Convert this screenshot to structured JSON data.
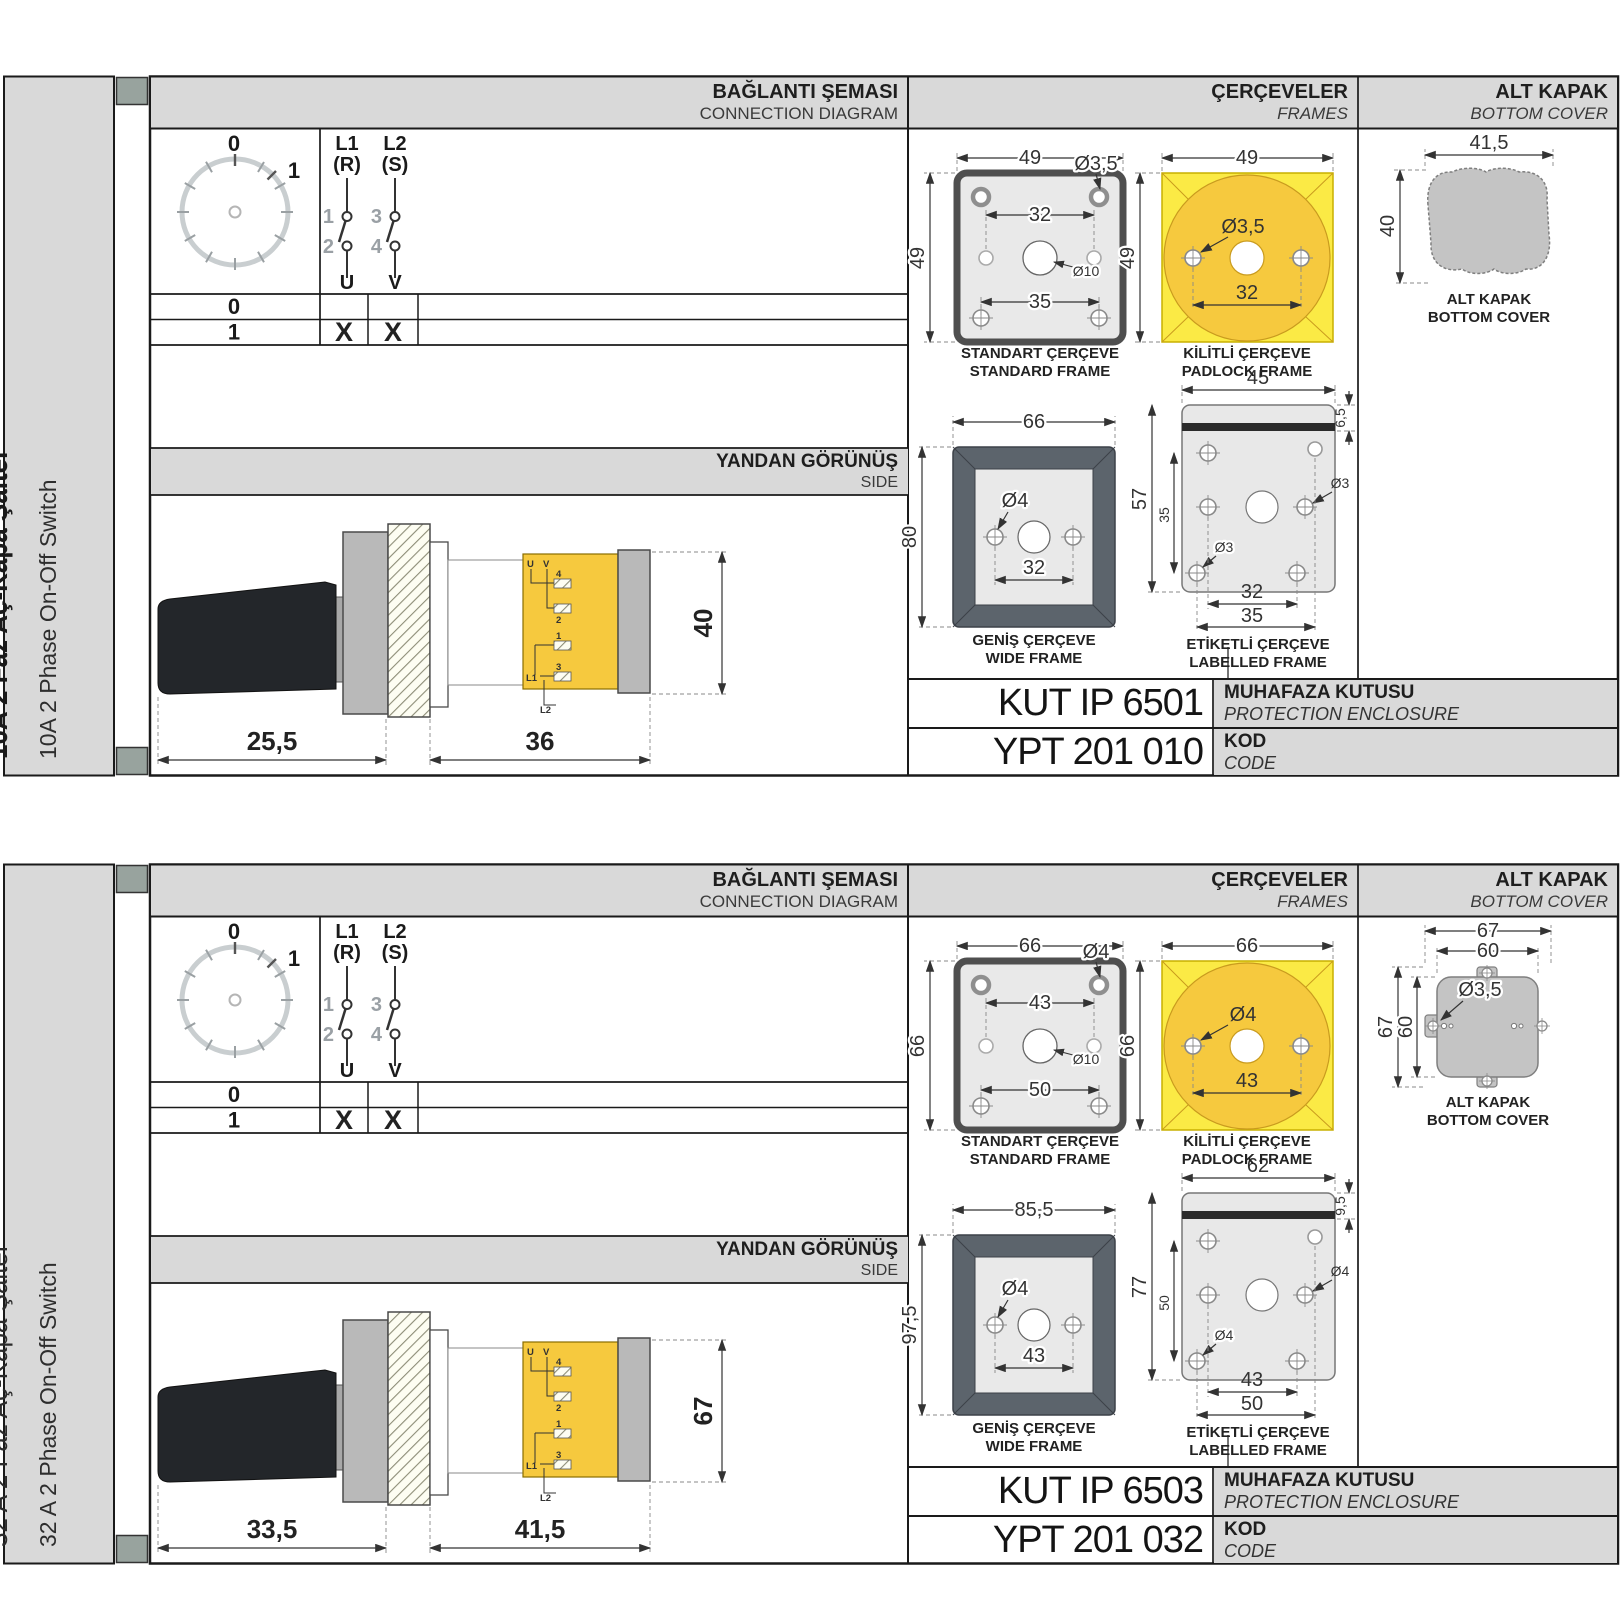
{
  "headers": {
    "connection_tr": "BAĞLANTI ŞEMASI",
    "connection_en": "CONNECTION DIAGRAM",
    "frames_tr": "ÇERÇEVELER",
    "frames_en": "FRAMES",
    "cover_tr": "ALT KAPAK",
    "cover_en": "BOTTOM COVER",
    "side_tr": "YANDAN GÖRÜNÜŞ",
    "side_en": "SIDE",
    "enclosure_tr": "MUHAFAZA KUTUSU",
    "enclosure_en": "PROTECTION ENCLOSURE",
    "code_tr": "KOD",
    "code_en": "CODE"
  },
  "frame_labels": {
    "standard_tr": "STANDART ÇERÇEVE",
    "standard_en": "STANDARD FRAME",
    "padlock_tr": "KİLİTLİ ÇERÇEVE",
    "padlock_en": "PADLOCK FRAME",
    "wide_tr": "GENİŞ ÇERÇEVE",
    "wide_en": "WIDE FRAME",
    "labelled_tr": "ETİKETLİ ÇERÇEVE",
    "labelled_en": "LABELLED FRAME",
    "cover_tr": "ALT KAPAK",
    "cover_en": "BOTTOM COVER"
  },
  "diagram": {
    "positions": [
      "0",
      "1"
    ],
    "col1": {
      "line": "L1",
      "phase": "(R)",
      "t_top": "1",
      "t_bot": "2",
      "out": "U"
    },
    "col2": {
      "line": "L2",
      "phase": "(S)",
      "t_top": "3",
      "t_bot": "4",
      "out": "V"
    },
    "rows": [
      {
        "label": "0",
        "c1": "",
        "c2": ""
      },
      {
        "label": "1",
        "c1": "X",
        "c2": "X"
      }
    ]
  },
  "side_terminals": {
    "u": "U",
    "v": "V",
    "n4": "4",
    "n2": "2",
    "n1": "1",
    "n3": "3",
    "l1": "L1",
    "l2": "L2"
  },
  "colors": {
    "panel_gray": "#d9d9d9",
    "tab_square": "#98a39e",
    "yellow_square": "#fbea45",
    "yellow_circle": "#f6c93e",
    "frame_dark": "#5c646c",
    "cover_gray": "#c4c4c4"
  },
  "sections": [
    {
      "title_tr": "10A 2 Faz Aç-Kapa Şalter",
      "title_en": "10A 2 Phase On-Off Switch",
      "side": {
        "d1": "25,5",
        "d2": "36",
        "h": "40"
      },
      "standard": {
        "w": "49",
        "h": "49",
        "hole": "Ø3,5",
        "inner": "32",
        "center": "Ø10",
        "bottom": "35"
      },
      "padlock": {
        "w": "49",
        "h": "49",
        "hole": "Ø3,5",
        "inner": "32"
      },
      "wide": {
        "w": "66",
        "h": "80",
        "hole": "Ø4",
        "inner": "32"
      },
      "labelled": {
        "w": "45",
        "top": "6,5",
        "h": "57",
        "h2": "35",
        "hole1": "Ø3",
        "hole2": "Ø3",
        "b1": "32",
        "b2": "35"
      },
      "cover": {
        "w": "41,5",
        "h": "40"
      },
      "enclosure_code": "KUT IP 6501",
      "code": "YPT 201 010"
    },
    {
      "title_tr": "32 A 2 Faz Aç-Kapa Şalter",
      "title_en": "32 A 2 Phase On-Off Switch",
      "side": {
        "d1": "33,5",
        "d2": "41,5",
        "h": "67"
      },
      "standard": {
        "w": "66",
        "h": "66",
        "hole": "Ø4",
        "inner": "43",
        "center": "Ø10",
        "bottom": "50"
      },
      "padlock": {
        "w": "66",
        "h": "66",
        "hole": "Ø4",
        "inner": "43"
      },
      "wide": {
        "w": "85,5",
        "h": "97,5",
        "hole": "Ø4",
        "inner": "43"
      },
      "labelled": {
        "w": "62",
        "top": "9,5",
        "h": "77",
        "h2": "50",
        "hole1": "Ø4",
        "hole2": "Ø4",
        "b1": "43",
        "b2": "50"
      },
      "cover": {
        "w": "67",
        "w2": "60",
        "h": "67",
        "h2": "60",
        "hole": "Ø3,5"
      },
      "enclosure_code": "KUT IP 6503",
      "code": "YPT 201 032"
    }
  ]
}
